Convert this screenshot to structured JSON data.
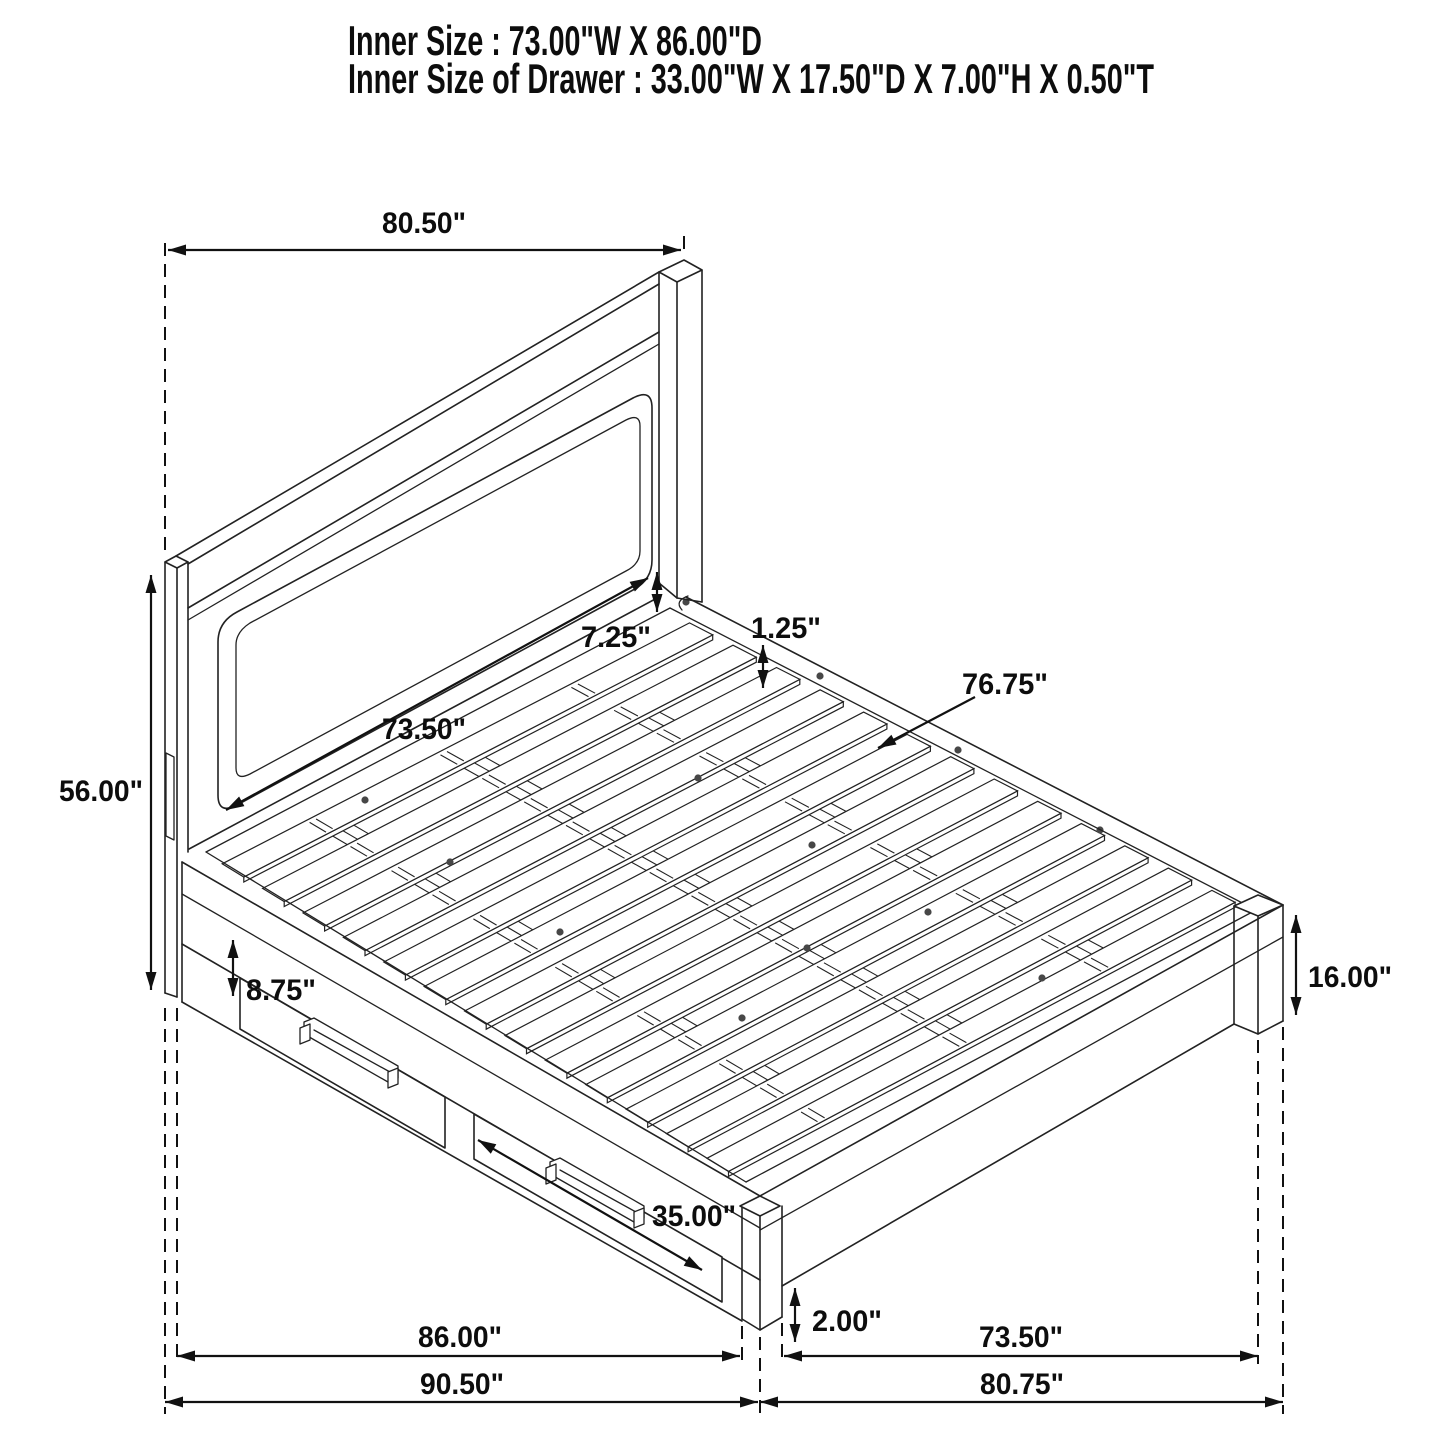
{
  "title_block": {
    "line1": "Inner Size : 73.00\"W X 86.00\"D",
    "line2": "Inner Size of Drawer : 33.00\"W X 17.50\"D X 7.00\"H X 0.50\"T"
  },
  "dimensions": {
    "headboard_width": "80.50\"",
    "headboard_height": "56.00\"",
    "headboard_panel_width": "73.50\"",
    "panel_to_platform_gap": "7.25\"",
    "platform_frame_lip": "1.25\"",
    "slat_length": "76.75\"",
    "side_rail_height": "8.75\"",
    "drawer_front_width": "35.00\"",
    "footboard_height": "16.00\"",
    "foot_clearance": "2.00\"",
    "storage_box_depth": "86.00\"",
    "overall_depth": "90.50\"",
    "platform_width": "73.50\"",
    "overall_width": "80.75\""
  },
  "style": {
    "line_color": "#222222",
    "dimension_color": "#111111",
    "text_color": "#0d0d0d",
    "background": "#ffffff"
  }
}
